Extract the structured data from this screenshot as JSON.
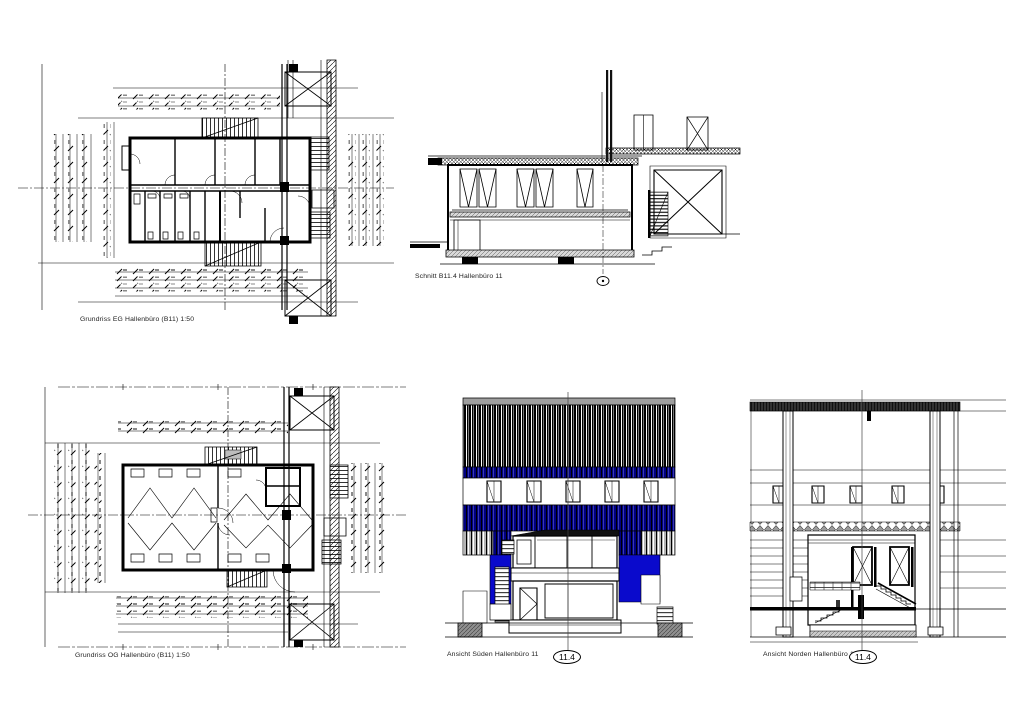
{
  "sheet": {
    "background": "#ffffff",
    "description": "Architectural drawing sheet with two floor plans, one section and two elevations of a hall office (Hallenbüro 11)"
  },
  "colors": {
    "ink": "#000000",
    "navy_band": "#000080",
    "navy_stripe_light": "#3a3aae",
    "blue_panel": "#0a0acc",
    "gray_cladding": "#b5b5b5",
    "plinth_gray": "#8f8f8f"
  },
  "drawings": {
    "plan_eg": {
      "caption": "Grundriss EG Hallenbüro (B11) 1:50"
    },
    "section": {
      "caption": "Schnitt B11.4 Hallenbüro 11"
    },
    "plan_og": {
      "caption": "Grundriss OG Hallenbüro (B11) 1:50"
    },
    "elevation_south": {
      "caption": "Ansicht Süden Hallenbüro 11",
      "axis_marker": "11.4"
    },
    "elevation_north": {
      "caption": "Ansicht Norden Hallenbüro 11",
      "axis_marker": "11.4"
    }
  }
}
